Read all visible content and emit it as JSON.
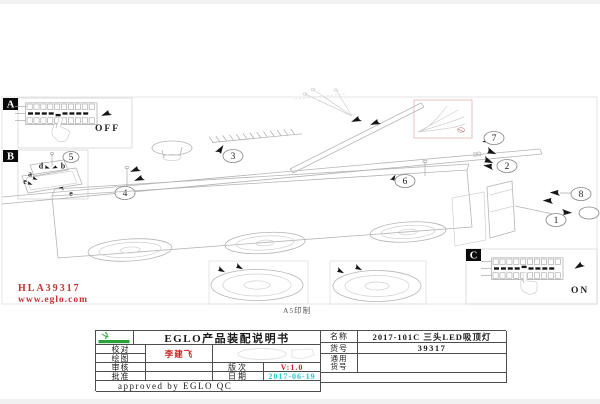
{
  "colors": {
    "accent_red": "#c23333",
    "date_cyan": "#27c6d4",
    "logo_green": "#2aa23c",
    "line_gray": "#b4b4b4"
  },
  "drawing": {
    "section_a": {
      "label": "A",
      "state": "OFF"
    },
    "section_b": {
      "label": "B"
    },
    "section_c": {
      "label": "C",
      "state": "ON"
    },
    "part_labels": {
      "pa": "a",
      "pb": "b",
      "pd": "d",
      "pe1": "e",
      "pe2": "e"
    },
    "callouts": {
      "n1": "1",
      "n2": "2",
      "n3": "3",
      "n4": "4",
      "n5": "5",
      "n6": "6",
      "n7": "7",
      "n8": "8"
    }
  },
  "footer": {
    "doc_code": "HLA39317",
    "website": "www.eglo.com",
    "print_note": "A5印制"
  },
  "title_block": {
    "title": "EGLO产品装配说明书",
    "rows": {
      "check": "校对",
      "draft": "绘图",
      "drafter": "李建飞",
      "review": "审核",
      "approve": "批准",
      "version_label": "版次",
      "version": "V:1.0",
      "date_label": "日期",
      "date": "2017-06-19",
      "name_label": "名称",
      "name": "2017-101C 三头LED吸顶灯",
      "sku_label": "货号",
      "sku": "39317",
      "common_label_line1": "通用",
      "common_label_line2": "货号",
      "approved": "approved by EGLO QC"
    }
  }
}
